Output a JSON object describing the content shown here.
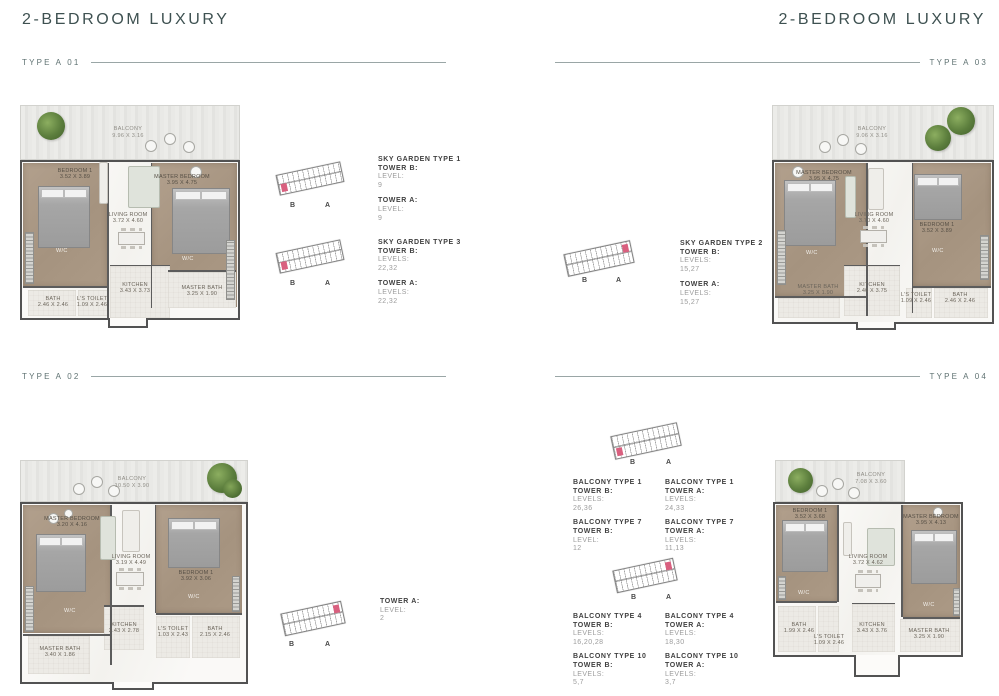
{
  "page": {
    "title": "2-BEDROOM LUXURY",
    "colors": {
      "heading": "#3e5151",
      "rule": "#9aa6a6",
      "highlight": "#d9607f"
    }
  },
  "sections": {
    "a01": {
      "label": "TYPE A 01",
      "plan": {
        "balcony": {
          "name": "BALCONY",
          "dims": "9.96 X 3.16"
        },
        "bedroom1": {
          "name": "BEDROOM 1",
          "dims": "3.52 X 3.89"
        },
        "master": {
          "name": "MASTER BEDROOM",
          "dims": "3.95 X 4.75"
        },
        "living": {
          "name": "LIVING ROOM",
          "dims": "3.72 X 4.60"
        },
        "kitchen": {
          "name": "KITCHEN",
          "dims": "3.43 X 3.73"
        },
        "bath": {
          "name": "BATH",
          "dims": "2.46 X 2.46"
        },
        "toilet": {
          "name": "L'S TOILET",
          "dims": "1.09 X 2.46"
        },
        "master_bath": {
          "name": "MASTER BATH",
          "dims": "3.25 X 1.90"
        },
        "wc": "W/C"
      },
      "keyplans": [
        {
          "b": "B",
          "a": "A",
          "highlight": "left"
        },
        {
          "b": "B",
          "a": "A",
          "highlight": "left"
        }
      ],
      "blocks": [
        {
          "heading": "SKY GARDEN TYPE 1",
          "groups": [
            {
              "tower": "TOWER B:",
              "label": "LEVEL:",
              "value": "9"
            },
            {
              "tower": "TOWER A:",
              "label": "LEVEL:",
              "value": "9"
            }
          ]
        },
        {
          "heading": "SKY GARDEN TYPE 3",
          "groups": [
            {
              "tower": "TOWER B:",
              "label": "LEVELS:",
              "value": "22,32"
            },
            {
              "tower": "TOWER A:",
              "label": "LEVELS:",
              "value": "22,32"
            }
          ]
        }
      ]
    },
    "a02": {
      "label": "TYPE A 02",
      "plan": {
        "balcony": {
          "name": "BALCONY",
          "dims": "10.50 X 3.90"
        },
        "master": {
          "name": "MASTER BEDROOM",
          "dims": "3.20 X 4.16"
        },
        "bedroom1": {
          "name": "BEDROOM 1",
          "dims": "3.92 X 3.06"
        },
        "living": {
          "name": "LIVING ROOM",
          "dims": "3.19 X 4.49"
        },
        "kitchen": {
          "name": "KITCHEN",
          "dims": "2.43 X 2.78"
        },
        "master_bath": {
          "name": "MASTER BATH",
          "dims": "3.40 X 1.86"
        },
        "toilet": {
          "name": "L'S TOILET",
          "dims": "1.03 X 2.43"
        },
        "bath": {
          "name": "BATH",
          "dims": "2.15 X 2.46"
        },
        "wc": "W/C"
      },
      "keyplans": [
        {
          "b": "B",
          "a": "A",
          "highlight": "right"
        }
      ],
      "blocks": [
        {
          "groups": [
            {
              "tower": "TOWER A:",
              "label": "LEVEL:",
              "value": "2"
            }
          ]
        }
      ]
    },
    "a03": {
      "label": "TYPE A 03",
      "plan": {
        "balcony": {
          "name": "BALCONY",
          "dims": "9.06 X 3.16"
        },
        "master": {
          "name": "MASTER BEDROOM",
          "dims": "3.95 X 4.75"
        },
        "bedroom1": {
          "name": "BEDROOM 1",
          "dims": "3.52 X 3.89"
        },
        "living": {
          "name": "LIVING ROOM",
          "dims": "3.70 X 4.60"
        },
        "kitchen": {
          "name": "KITCHEN",
          "dims": "2.40 X 3.75"
        },
        "master_bath": {
          "name": "MASTER BATH",
          "dims": "3.25 X 1.90"
        },
        "toilet": {
          "name": "L'S TOILET",
          "dims": "1.09 X 2.46"
        },
        "bath": {
          "name": "BATH",
          "dims": "2.46 X 2.46"
        },
        "wc": "W/C"
      },
      "keyplans": [
        {
          "b": "B",
          "a": "A",
          "highlight": "right"
        }
      ],
      "blocks": [
        {
          "heading": "SKY GARDEN TYPE 2",
          "groups": [
            {
              "tower": "TOWER B:",
              "label": "LEVELS:",
              "value": "15,27"
            },
            {
              "tower": "TOWER A:",
              "label": "LEVELS:",
              "value": "15,27"
            }
          ]
        }
      ]
    },
    "a04": {
      "label": "TYPE A 04",
      "plan": {
        "balcony": {
          "name": "BALCONY",
          "dims": "7.08 X 3.60"
        },
        "bedroom1": {
          "name": "BEDROOM 1",
          "dims": "3.52 X 3.68"
        },
        "master": {
          "name": "MASTER BEDROOM",
          "dims": "3.95 X 4.13"
        },
        "living": {
          "name": "LIVING ROOM",
          "dims": "3.72 X 4.62"
        },
        "kitchen": {
          "name": "KITCHEN",
          "dims": "3.43 X 3.76"
        },
        "bath": {
          "name": "BATH",
          "dims": "1.99 X 2.46"
        },
        "toilet": {
          "name": "L'S TOILET",
          "dims": "1.09 X 2.46"
        },
        "master_bath": {
          "name": "MASTER BATH",
          "dims": "3.25 X 1.90"
        },
        "wc": "W/C"
      },
      "keyplans": [
        {
          "b": "B",
          "a": "A",
          "highlight": "left"
        },
        {
          "b": "B",
          "a": "A",
          "highlight": "right"
        }
      ],
      "blocks": [
        {
          "col_b": [
            {
              "heading": "BALCONY TYPE 1",
              "tower": "TOWER B:",
              "label": "LEVELS:",
              "value": "26,36"
            },
            {
              "heading": "BALCONY TYPE 7",
              "tower": "TOWER B:",
              "label": "LEVEL:",
              "value": "12"
            }
          ],
          "col_a": [
            {
              "heading": "BALCONY TYPE 1",
              "tower": "TOWER A:",
              "label": "LEVELS:",
              "value": "24,33"
            },
            {
              "heading": "BALCONY TYPE 7",
              "tower": "TOWER A:",
              "label": "LEVELS:",
              "value": "11,13"
            }
          ]
        },
        {
          "col_b": [
            {
              "heading": "BALCONY TYPE 4",
              "tower": "TOWER B:",
              "label": "LEVELS:",
              "value": "16,20,28"
            },
            {
              "heading": "BALCONY TYPE 10",
              "tower": "TOWER B:",
              "label": "LEVELS:",
              "value": "5,7"
            }
          ],
          "col_a": [
            {
              "heading": "BALCONY TYPE 4",
              "tower": "TOWER A:",
              "label": "LEVELS:",
              "value": "18,30"
            },
            {
              "heading": "BALCONY TYPE 10",
              "tower": "TOWER A:",
              "label": "LEVELS:",
              "value": "3,7"
            }
          ]
        }
      ]
    }
  }
}
